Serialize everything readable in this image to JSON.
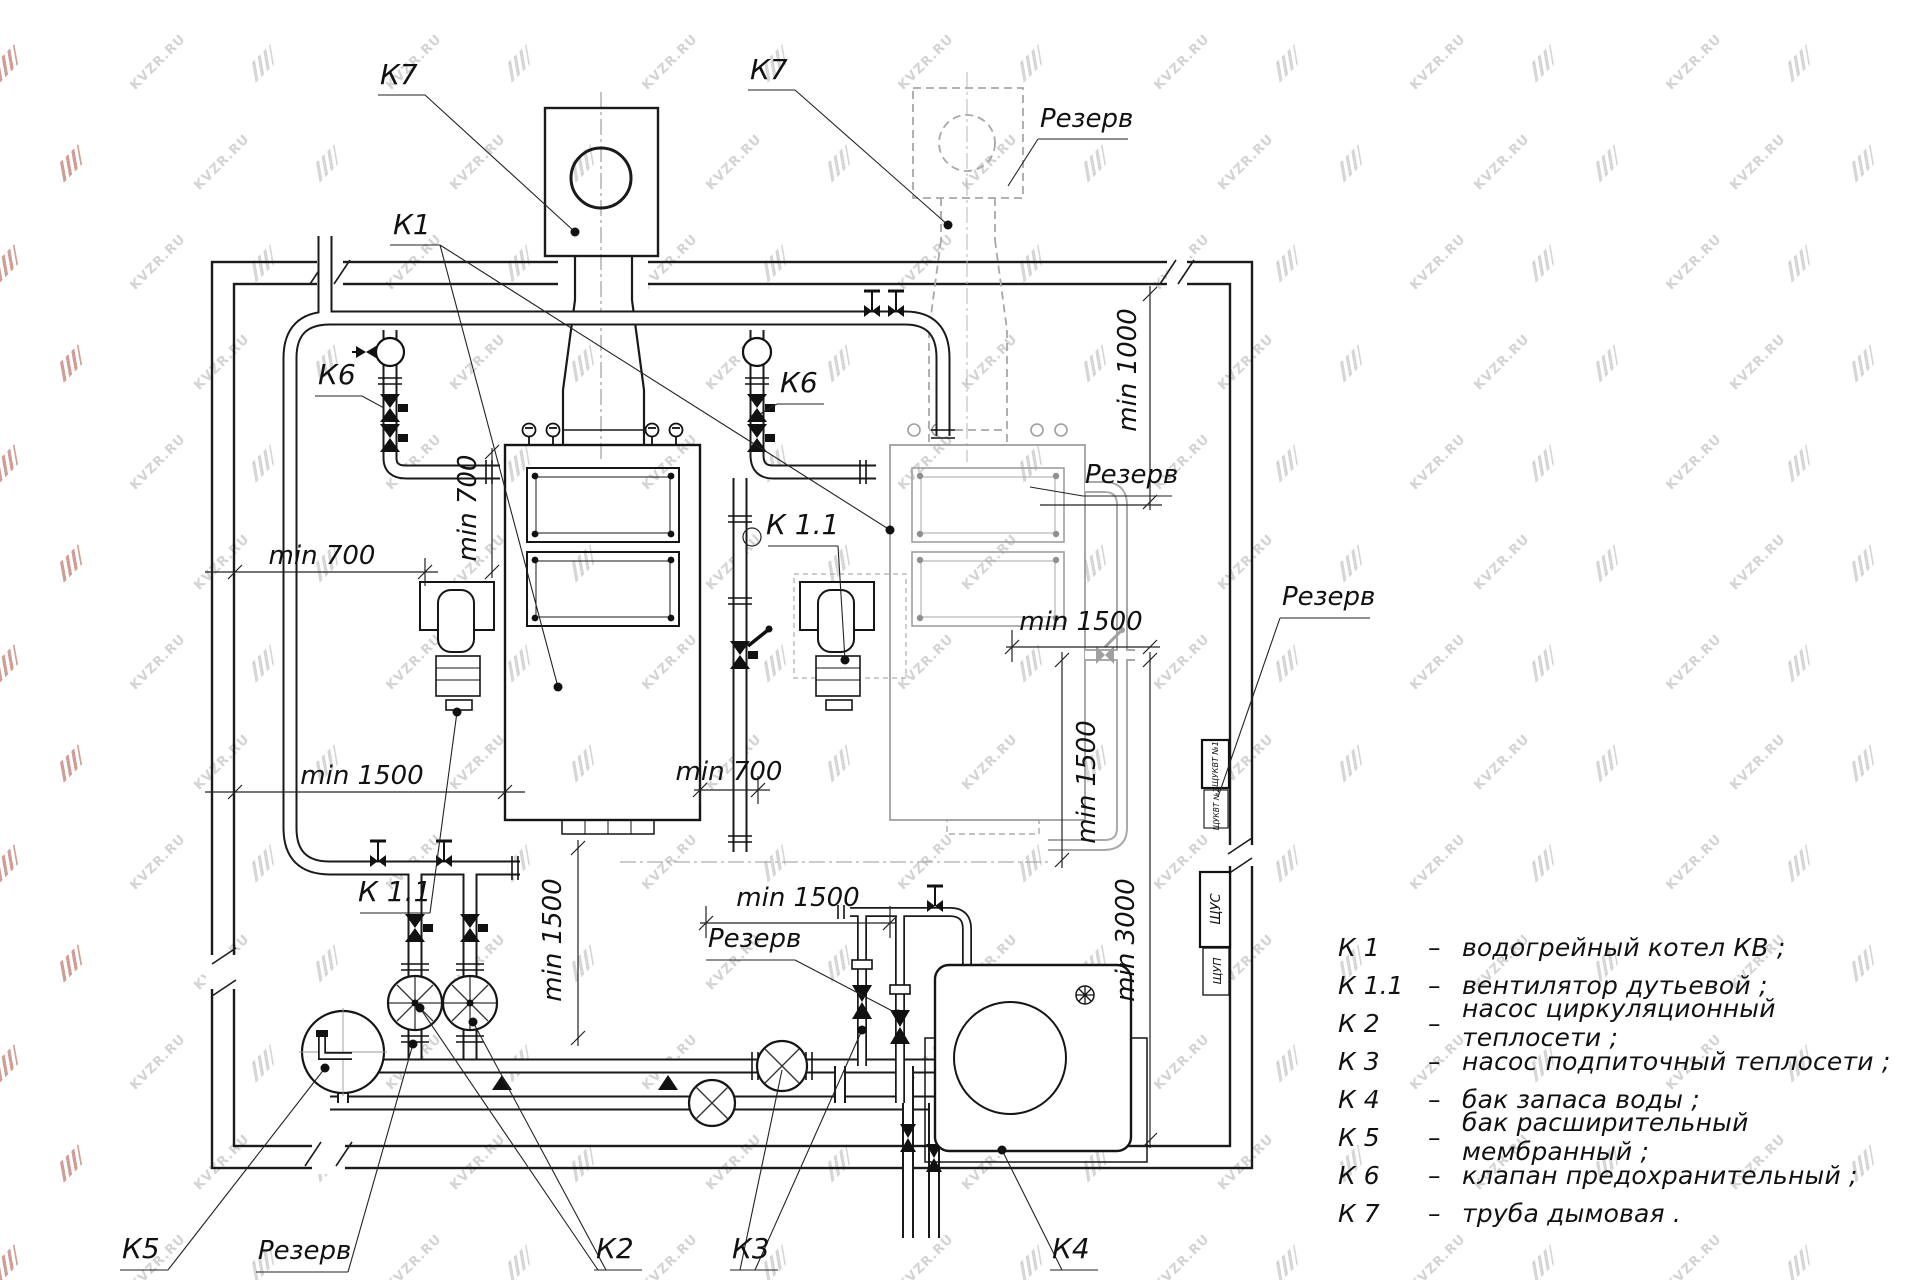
{
  "watermark": {
    "text": "KVZR.RU",
    "gray": "#c9c9c9",
    "red": "#c27d72"
  },
  "labels": {
    "k7_left": "К7",
    "k7_right": "К7",
    "rezerv_top": "Резерв",
    "k1": "К1",
    "k6_left": "К6",
    "k6_right": "К6",
    "k11_mid": "К 1.1",
    "k11_left": "К 1.1",
    "rezerv_boiler2": "Резерв",
    "rezerv_right": "Резерв",
    "rezerv_mid": "Резерв",
    "rezerv_bottom": "Резерв",
    "k2": "К2",
    "k3": "К3",
    "k4": "К4",
    "k5": "К5"
  },
  "dimensions": {
    "d700_left": "min 700",
    "d1500_left": "min 1500",
    "d700_vert": "min 700",
    "d700_mid": "min 700",
    "d1500_mid": "min 1500",
    "d1500_vleft": "min 1500",
    "d1500_right": "min 1500",
    "d1500_vright": "min 1500",
    "d3000": "min 3000",
    "d1000": "min 1000"
  },
  "cabinets": {
    "c1": "ЩУКВТ №1",
    "c2": "ЩУКВТ №2",
    "c3": "ЩУС",
    "c4": "ЩУП"
  },
  "legend": {
    "separator": "–",
    "items": [
      {
        "code": "К 1",
        "desc": "водогрейный котел КВ ;"
      },
      {
        "code": "К 1.1",
        "desc": "вентилятор дутьевой ;"
      },
      {
        "code": "К 2",
        "desc": "насос циркуляционный теплосети ;"
      },
      {
        "code": "К 3",
        "desc": "насос подпиточный теплосети ;"
      },
      {
        "code": "К 4",
        "desc": "бак запаса воды ;"
      },
      {
        "code": "К 5",
        "desc": "бак расширительный мембранный ;"
      },
      {
        "code": "К 6",
        "desc": "клапан предохранительный ;"
      },
      {
        "code": "К 7",
        "desc": "труба дымовая ."
      }
    ]
  }
}
